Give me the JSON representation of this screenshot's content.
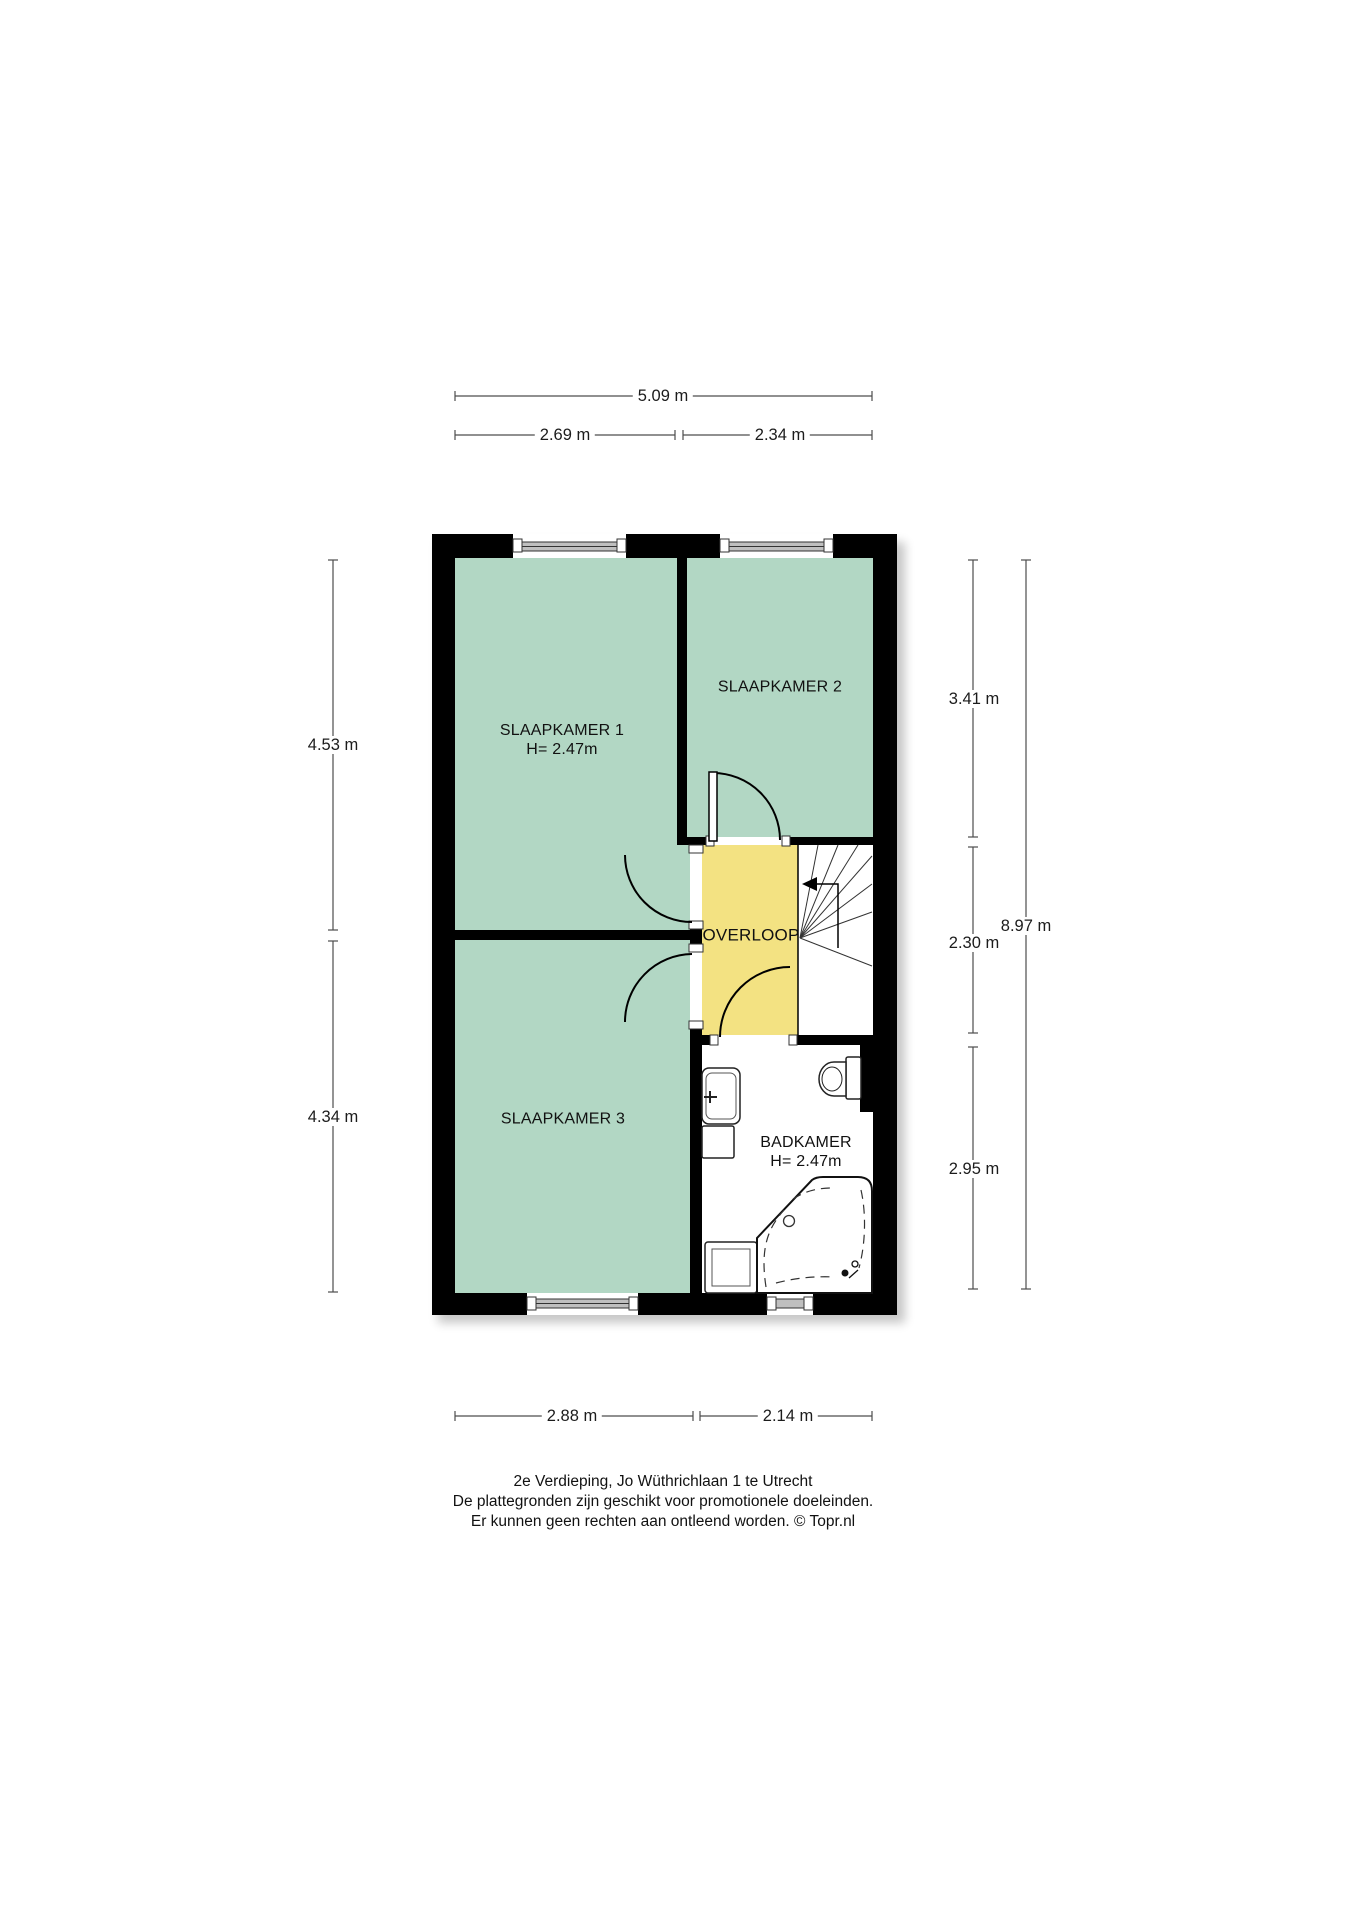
{
  "plan": {
    "rooms": {
      "slaapkamer1": {
        "label": "SLAAPKAMER 1",
        "height": "H= 2.47m"
      },
      "slaapkamer2": {
        "label": "SLAAPKAMER 2"
      },
      "slaapkamer3": {
        "label": "SLAAPKAMER 3"
      },
      "overloop": {
        "label": "OVERLOOP"
      },
      "badkamer": {
        "label": "BADKAMER",
        "height": "H= 2.47m"
      }
    },
    "dimensions": {
      "top_total": "5.09 m",
      "top_left": "2.69 m",
      "top_right": "2.34 m",
      "bottom_left": "2.88 m",
      "bottom_right": "2.14 m",
      "left_upper": "4.53 m",
      "left_lower": "4.34 m",
      "right_upper": "3.41 m",
      "right_middle": "2.30 m",
      "right_lower": "2.95 m",
      "right_total": "8.97 m"
    },
    "caption": {
      "line1": "2e Verdieping, Jo Wüthrichlaan 1 te Utrecht",
      "line2": "De plattegronden zijn geschikt voor promotionele doeleinden.",
      "line3": "Er kunnen geen rechten aan ontleend worden. © Topr.nl"
    },
    "colors": {
      "room_green": "#b2d7c4",
      "hall_yellow": "#f3e282",
      "wall_black": "#000000"
    }
  }
}
